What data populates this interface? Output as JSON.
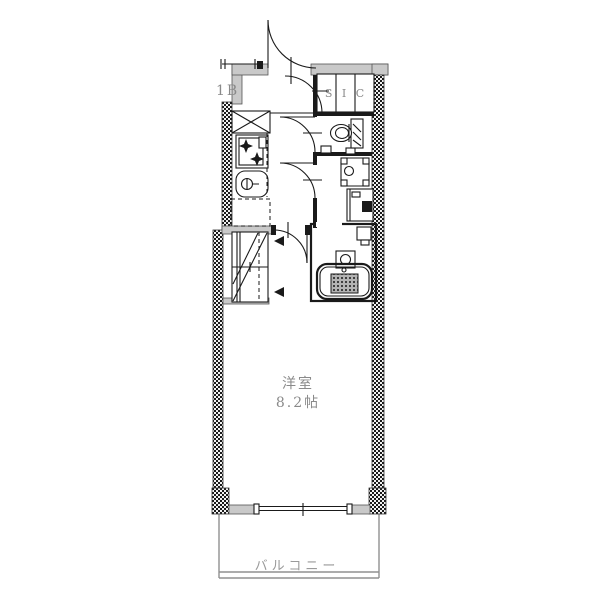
{
  "drawing_title": "apartment-floor-plan",
  "colors": {
    "bg": "#ffffff",
    "wall": "#c9c9c9",
    "ink": "#1a1a1a",
    "label": "#8a8a8a",
    "thin": "#909090"
  },
  "labels": {
    "unit": "1B",
    "shoe_closet": "S I C",
    "room_name": "洋室",
    "room_size": "8.2帖",
    "balcony": "バルコニー"
  },
  "fixtures": [
    "entrance-door",
    "shoe-in-closet",
    "kitchen-stove",
    "kitchen-sink",
    "pipe-space",
    "refrigerator-space",
    "closet",
    "toilet",
    "washbasin",
    "washing-machine",
    "bathroom",
    "bathtub",
    "balcony-window"
  ]
}
